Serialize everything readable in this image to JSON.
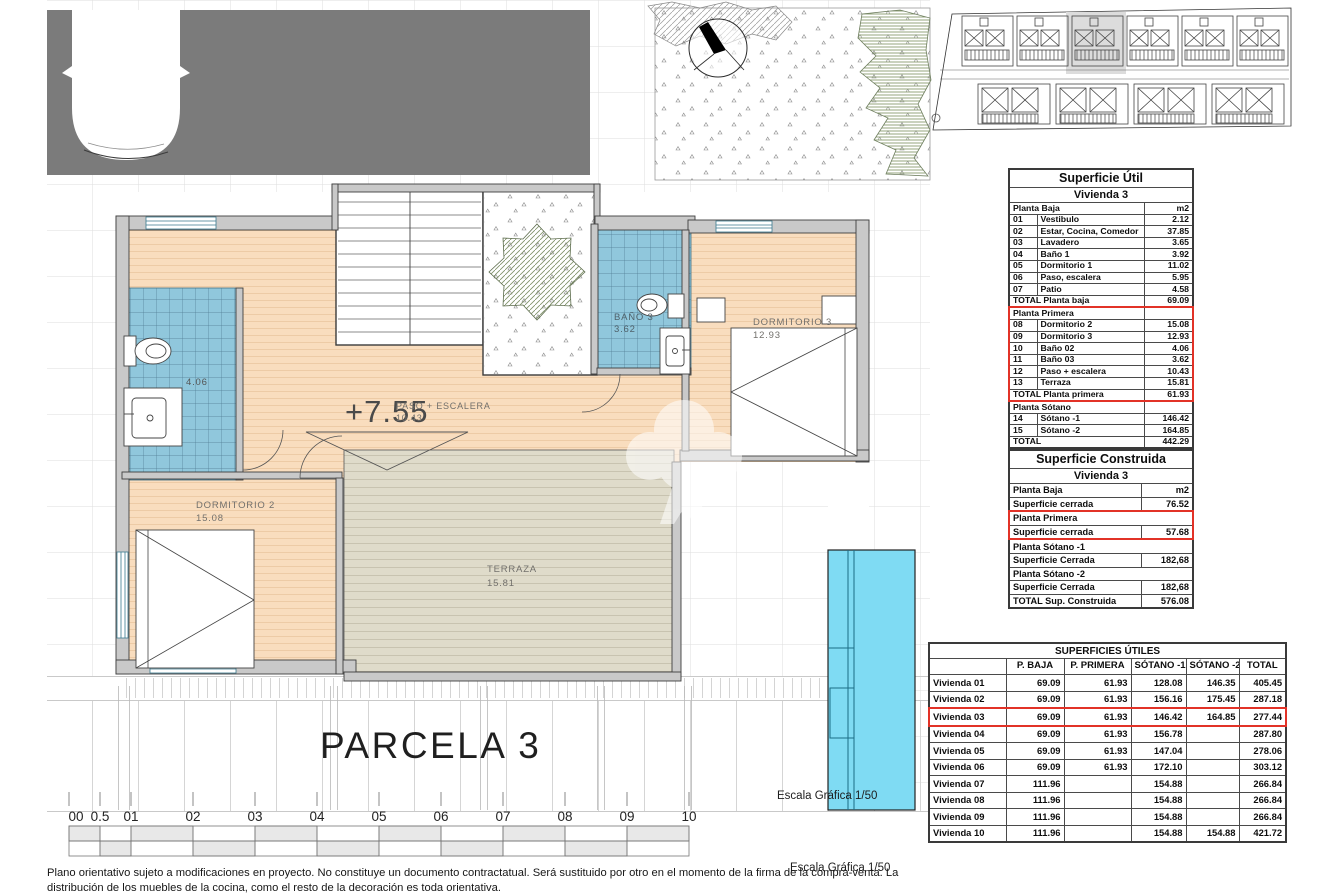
{
  "plan": {
    "level": "+7.55",
    "parcel": "PARCELA 3",
    "rooms": {
      "paso": {
        "name": "PASO + ESCALERA",
        "area": "10.43"
      },
      "bano2": {
        "area": "4.06"
      },
      "bano3": {
        "name": "BAÑO 3",
        "area": "3.62"
      },
      "dormitorio2": {
        "name": "DORMITORIO 2",
        "area": "15.08"
      },
      "dormitorio3": {
        "name": "DORMITORIO 3",
        "area": "12.93"
      },
      "terraza": {
        "name": "TERRAZA",
        "area": "15.81"
      }
    }
  },
  "scale": {
    "label": "Escala Gráfica 1/50",
    "numbers": [
      "00",
      "0.5",
      "01",
      "02",
      "03",
      "04",
      "05",
      "06",
      "07",
      "08",
      "09",
      "10"
    ]
  },
  "tables": {
    "util": {
      "title": "Superficie Útil",
      "subtitle": "Vivienda 3",
      "rows": [
        {
          "cls": "section",
          "cells": [
            {
              "t": "Planta Baja",
              "cs": 2
            },
            {
              "t": "m2",
              "al": "r"
            }
          ]
        },
        {
          "cells": [
            {
              "t": "01"
            },
            {
              "t": "Vestibulo"
            },
            {
              "t": "2.12",
              "al": "r"
            }
          ]
        },
        {
          "cells": [
            {
              "t": "02"
            },
            {
              "t": "Estar, Cocina, Comedor"
            },
            {
              "t": "37.85",
              "al": "r"
            }
          ]
        },
        {
          "cells": [
            {
              "t": "03"
            },
            {
              "t": "Lavadero"
            },
            {
              "t": "3.65",
              "al": "r"
            }
          ]
        },
        {
          "cells": [
            {
              "t": "04"
            },
            {
              "t": "Baño 1"
            },
            {
              "t": "3.92",
              "al": "r"
            }
          ]
        },
        {
          "cells": [
            {
              "t": "05"
            },
            {
              "t": "Dormitorio 1"
            },
            {
              "t": "11.02",
              "al": "r"
            }
          ]
        },
        {
          "cells": [
            {
              "t": "06"
            },
            {
              "t": "Paso, escalera"
            },
            {
              "t": "5.95",
              "al": "r"
            }
          ]
        },
        {
          "cells": [
            {
              "t": "07"
            },
            {
              "t": "Patio"
            },
            {
              "t": "4.58",
              "al": "r"
            }
          ]
        },
        {
          "cls": "total",
          "cells": [
            {
              "t": "TOTAL Planta baja",
              "cs": 2
            },
            {
              "t": "69.09",
              "al": "r"
            }
          ]
        },
        {
          "cls": "section rs rt",
          "cells": [
            {
              "t": "Planta Primera",
              "cs": 2
            },
            {
              "t": ""
            }
          ]
        },
        {
          "cls": "rs",
          "cells": [
            {
              "t": "08"
            },
            {
              "t": "Dormitorio 2"
            },
            {
              "t": "15.08",
              "al": "r"
            }
          ]
        },
        {
          "cls": "rs",
          "cells": [
            {
              "t": "09"
            },
            {
              "t": "Dormitorio 3"
            },
            {
              "t": "12.93",
              "al": "r"
            }
          ]
        },
        {
          "cls": "rs",
          "cells": [
            {
              "t": "10"
            },
            {
              "t": "Baño 02"
            },
            {
              "t": "4.06",
              "al": "r"
            }
          ]
        },
        {
          "cls": "rs",
          "cells": [
            {
              "t": "11"
            },
            {
              "t": "Baño 03"
            },
            {
              "t": "3.62",
              "al": "r"
            }
          ]
        },
        {
          "cls": "rs",
          "cells": [
            {
              "t": "12"
            },
            {
              "t": "Paso + escalera"
            },
            {
              "t": "10.43",
              "al": "r"
            }
          ]
        },
        {
          "cls": "rs",
          "cells": [
            {
              "t": "13"
            },
            {
              "t": "Terraza"
            },
            {
              "t": "15.81",
              "al": "r"
            }
          ]
        },
        {
          "cls": "total rs rb",
          "cells": [
            {
              "t": "TOTAL Planta primera",
              "cs": 2
            },
            {
              "t": "61.93",
              "al": "r"
            }
          ]
        },
        {
          "cls": "section",
          "cells": [
            {
              "t": "Planta Sótano",
              "cs": 2
            },
            {
              "t": ""
            }
          ]
        },
        {
          "cells": [
            {
              "t": "14"
            },
            {
              "t": "Sótano -1"
            },
            {
              "t": "146.42",
              "al": "r"
            }
          ]
        },
        {
          "cells": [
            {
              "t": "15"
            },
            {
              "t": "Sótano -2"
            },
            {
              "t": "164.85",
              "al": "r"
            }
          ]
        },
        {
          "cls": "total",
          "cells": [
            {
              "t": "TOTAL",
              "cs": 2
            },
            {
              "t": "442.29",
              "al": "r"
            }
          ]
        }
      ]
    },
    "construida": {
      "title": "Superficie Construida",
      "subtitle": "Vivienda 3",
      "rows": [
        {
          "cls": "section",
          "cells": [
            {
              "t": "Planta Baja"
            },
            {
              "t": "m2",
              "al": "r"
            }
          ]
        },
        {
          "cells": [
            {
              "t": "Superficie cerrada"
            },
            {
              "t": "76.52",
              "al": "r"
            }
          ]
        },
        {
          "cls": "section rs rt",
          "cells": [
            {
              "t": "Planta Primera",
              "cs": 2
            }
          ]
        },
        {
          "cls": "rs rb",
          "cells": [
            {
              "t": "Superficie cerrada"
            },
            {
              "t": "57.68",
              "al": "r"
            }
          ]
        },
        {
          "cls": "section",
          "cells": [
            {
              "t": "Planta Sótano -1",
              "cs": 2
            }
          ]
        },
        {
          "cells": [
            {
              "t": "Superficie Cerrada"
            },
            {
              "t": "182,68",
              "al": "r"
            }
          ]
        },
        {
          "cls": "section",
          "cells": [
            {
              "t": "Planta Sótano -2",
              "cs": 2
            }
          ]
        },
        {
          "cells": [
            {
              "t": "Superficie Cerrada"
            },
            {
              "t": "182,68",
              "al": "r"
            }
          ]
        },
        {
          "cls": "total",
          "cells": [
            {
              "t": "TOTAL Sup. Construida"
            },
            {
              "t": "576.08",
              "al": "r"
            }
          ]
        }
      ]
    },
    "superficies": {
      "title": "SUPERFICIES ÚTILES",
      "col_headers": [
        "P. BAJA",
        "P. PRIMERA",
        "SÓTANO -1",
        "SÓTANO -2",
        "TOTAL"
      ],
      "rows": [
        {
          "cells": [
            {
              "t": "Vivienda 01"
            },
            {
              "t": "69.09",
              "al": "r"
            },
            {
              "t": "61.93",
              "al": "r"
            },
            {
              "t": "128.08",
              "al": "r"
            },
            {
              "t": "146.35",
              "al": "r"
            },
            {
              "t": "405.45",
              "al": "r"
            }
          ]
        },
        {
          "cells": [
            {
              "t": "Vivienda 02"
            },
            {
              "t": "69.09",
              "al": "r"
            },
            {
              "t": "61.93",
              "al": "r"
            },
            {
              "t": "156.16",
              "al": "r"
            },
            {
              "t": "175.45",
              "al": "r"
            },
            {
              "t": "287.18",
              "al": "r"
            }
          ]
        },
        {
          "cls": "rs rt rb",
          "cells": [
            {
              "t": "Vivienda 03"
            },
            {
              "t": "69.09",
              "al": "r"
            },
            {
              "t": "61.93",
              "al": "r"
            },
            {
              "t": "146.42",
              "al": "r"
            },
            {
              "t": "164.85",
              "al": "r"
            },
            {
              "t": "277.44",
              "al": "r"
            }
          ]
        },
        {
          "cells": [
            {
              "t": "Vivienda 04"
            },
            {
              "t": "69.09",
              "al": "r"
            },
            {
              "t": "61.93",
              "al": "r"
            },
            {
              "t": "156.78",
              "al": "r"
            },
            {
              "t": ""
            },
            {
              "t": "287.80",
              "al": "r"
            }
          ]
        },
        {
          "cells": [
            {
              "t": "Vivienda 05"
            },
            {
              "t": "69.09",
              "al": "r"
            },
            {
              "t": "61.93",
              "al": "r"
            },
            {
              "t": "147.04",
              "al": "r"
            },
            {
              "t": ""
            },
            {
              "t": "278.06",
              "al": "r"
            }
          ]
        },
        {
          "cells": [
            {
              "t": "Vivienda 06"
            },
            {
              "t": "69.09",
              "al": "r"
            },
            {
              "t": "61.93",
              "al": "r"
            },
            {
              "t": "172.10",
              "al": "r"
            },
            {
              "t": ""
            },
            {
              "t": "303.12",
              "al": "r"
            }
          ]
        },
        {
          "cells": [
            {
              "t": "Vivienda 07"
            },
            {
              "t": "111.96",
              "al": "r"
            },
            {
              "t": ""
            },
            {
              "t": "154.88",
              "al": "r"
            },
            {
              "t": ""
            },
            {
              "t": "266.84",
              "al": "r"
            }
          ]
        },
        {
          "cells": [
            {
              "t": "Vivienda 08"
            },
            {
              "t": "111.96",
              "al": "r"
            },
            {
              "t": ""
            },
            {
              "t": "154.88",
              "al": "r"
            },
            {
              "t": ""
            },
            {
              "t": "266.84",
              "al": "r"
            }
          ]
        },
        {
          "cells": [
            {
              "t": "Vivienda 09"
            },
            {
              "t": "111.96",
              "al": "r"
            },
            {
              "t": ""
            },
            {
              "t": "154.88",
              "al": "r"
            },
            {
              "t": ""
            },
            {
              "t": "266.84",
              "al": "r"
            }
          ]
        },
        {
          "cells": [
            {
              "t": "Vivienda 10"
            },
            {
              "t": "111.96",
              "al": "r"
            },
            {
              "t": ""
            },
            {
              "t": "154.88",
              "al": "r"
            },
            {
              "t": "154.88",
              "al": "r"
            },
            {
              "t": "421.72",
              "al": "r"
            }
          ]
        }
      ]
    }
  },
  "footer": {
    "line1": "Plano orientativo sujeto a modificaciones en proyecto. No constituye un documento contractatual. Será sustituido por otro en el momento de la firma de la compra-venta. La",
    "line2": "distribución de los muebles de la cocina, como el resto de la decoración es toda orientativa."
  },
  "colors": {
    "highlight_red": "#e23227",
    "pool_cyan": "#7fdbf3",
    "tile_blue": "#90c7dc",
    "floor_peach": "#f9ddbe",
    "deck_tan": "#dfdbca",
    "roof_gray": "#7b7b7b"
  }
}
